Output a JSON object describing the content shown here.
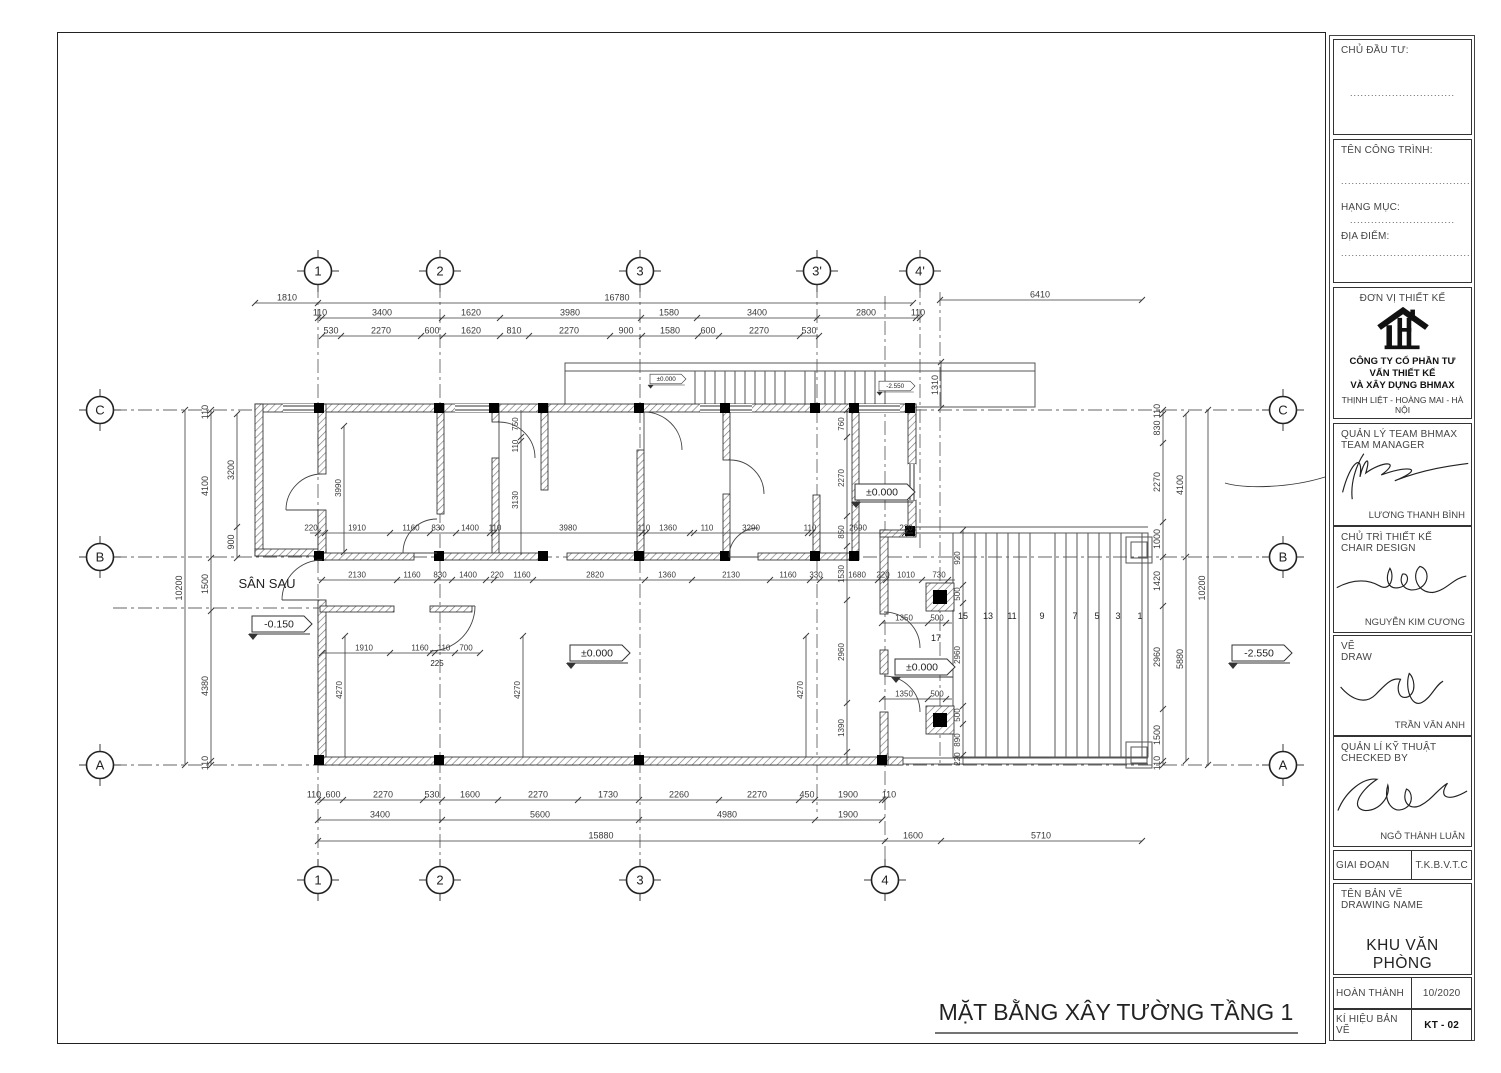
{
  "plan": {
    "bubbles": [
      {
        "t": "1",
        "x": 318,
        "y": 271
      },
      {
        "t": "2",
        "x": 440,
        "y": 271
      },
      {
        "t": "3",
        "x": 640,
        "y": 271
      },
      {
        "t": "3'",
        "x": 817,
        "y": 271
      },
      {
        "t": "4'",
        "x": 920,
        "y": 271
      },
      {
        "t": "1",
        "x": 318,
        "y": 880
      },
      {
        "t": "2",
        "x": 440,
        "y": 880
      },
      {
        "t": "3",
        "x": 640,
        "y": 880
      },
      {
        "t": "4",
        "x": 885,
        "y": 880
      },
      {
        "t": "C",
        "x": 100,
        "y": 410
      },
      {
        "t": "B",
        "x": 100,
        "y": 557
      },
      {
        "t": "A",
        "x": 100,
        "y": 765
      },
      {
        "t": "C",
        "x": 1283,
        "y": 410
      },
      {
        "t": "B",
        "x": 1283,
        "y": 557
      },
      {
        "t": "A",
        "x": 1283,
        "y": 765
      }
    ],
    "dim_rows": [
      {
        "o": "h",
        "y": 303,
        "x1": 255,
        "x2": 318,
        "ticks": [
          255,
          318
        ],
        "labels": [
          {
            "t": "1810",
            "x": 287
          }
        ]
      },
      {
        "o": "h",
        "y": 303,
        "x1": 318,
        "x2": 913,
        "ticks": [
          913
        ],
        "labels": [
          {
            "t": "16780",
            "x": 617
          }
        ]
      },
      {
        "o": "h",
        "y": 300,
        "x1": 940,
        "x2": 1142,
        "ticks": [
          940,
          1142
        ],
        "labels": [
          {
            "t": "6410",
            "x": 1040
          }
        ]
      },
      {
        "o": "h",
        "y": 318,
        "x1": 318,
        "x2": 920,
        "ticks": [
          318,
          322,
          442,
          500,
          641,
          697,
          817,
          916,
          920
        ],
        "labels": [
          {
            "t": "110",
            "x": 320
          },
          {
            "t": "3400",
            "x": 382
          },
          {
            "t": "1620",
            "x": 471
          },
          {
            "t": "3980",
            "x": 570
          },
          {
            "t": "1580",
            "x": 669
          },
          {
            "t": "3400",
            "x": 757
          },
          {
            "t": "2800",
            "x": 866
          },
          {
            "t": "110",
            "x": 918
          }
        ]
      },
      {
        "o": "h",
        "y": 336,
        "x1": 322,
        "x2": 819,
        "ticks": [
          322,
          341,
          421,
          443,
          500,
          529,
          610,
          642,
          698,
          719,
          800,
          819
        ],
        "labels": [
          {
            "t": "530",
            "x": 331
          },
          {
            "t": "2270",
            "x": 381
          },
          {
            "t": "600",
            "x": 432
          },
          {
            "t": "1620",
            "x": 471
          },
          {
            "t": "810",
            "x": 514
          },
          {
            "t": "2270",
            "x": 569
          },
          {
            "t": "900",
            "x": 626
          },
          {
            "t": "1580",
            "x": 670
          },
          {
            "t": "600",
            "x": 708
          },
          {
            "t": "2270",
            "x": 759
          },
          {
            "t": "530",
            "x": 809
          }
        ]
      },
      {
        "o": "h",
        "y": 800,
        "x1": 318,
        "x2": 885,
        "ticks": [
          318,
          322,
          343,
          423,
          442,
          498,
          578,
          639,
          719,
          799,
          815,
          882,
          885
        ],
        "labels": [
          {
            "t": "110",
            "x": 314
          },
          {
            "t": "600",
            "x": 333
          },
          {
            "t": "2270",
            "x": 383
          },
          {
            "t": "530",
            "x": 432
          },
          {
            "t": "1600",
            "x": 470
          },
          {
            "t": "2270",
            "x": 538
          },
          {
            "t": "1730",
            "x": 608
          },
          {
            "t": "2260",
            "x": 679
          },
          {
            "t": "2270",
            "x": 757
          },
          {
            "t": "450",
            "x": 807
          },
          {
            "t": "1900",
            "x": 848
          },
          {
            "t": "110",
            "x": 889
          }
        ]
      },
      {
        "o": "h",
        "y": 820,
        "x1": 318,
        "x2": 882,
        "ticks": [
          318,
          442,
          639,
          815,
          882
        ],
        "labels": [
          {
            "t": "3400",
            "x": 380
          },
          {
            "t": "5600",
            "x": 540
          },
          {
            "t": "4980",
            "x": 727
          },
          {
            "t": "1900",
            "x": 848
          }
        ]
      },
      {
        "o": "h",
        "y": 841,
        "x1": 318,
        "x2": 1142,
        "ticks": [
          318,
          885,
          941,
          1142
        ],
        "labels": [
          {
            "t": "15880",
            "x": 601
          },
          {
            "t": "1600",
            "x": 913
          },
          {
            "t": "5710",
            "x": 1041
          }
        ]
      },
      {
        "o": "v",
        "x": 185,
        "y1": 410,
        "y2": 765,
        "ticks": [
          410,
          765
        ],
        "labels": [
          {
            "t": "10200",
            "y": 588
          }
        ]
      },
      {
        "o": "v",
        "x": 211,
        "y1": 410,
        "y2": 765,
        "ticks": [
          410,
          414,
          558,
          611,
          761,
          765
        ],
        "labels": [
          {
            "t": "110",
            "y": 412
          },
          {
            "t": "4100",
            "y": 486
          },
          {
            "t": "1500",
            "y": 584
          },
          {
            "t": "4380",
            "y": 686
          },
          {
            "t": "110",
            "y": 763
          }
        ]
      },
      {
        "o": "v",
        "x": 237,
        "y1": 414,
        "y2": 558,
        "ticks": [
          414,
          527,
          558
        ],
        "labels": [
          {
            "t": "3200",
            "y": 470
          },
          {
            "t": "900",
            "y": 542
          }
        ]
      },
      {
        "o": "v",
        "x": 1163,
        "y1": 410,
        "y2": 765,
        "ticks": [
          410,
          414,
          443,
          522,
          557,
          606,
          709,
          761,
          765
        ],
        "labels": [
          {
            "t": "110",
            "y": 411
          },
          {
            "t": "830",
            "y": 428
          },
          {
            "t": "2270",
            "y": 482
          },
          {
            "t": "1000",
            "y": 539
          },
          {
            "t": "1420",
            "y": 581
          },
          {
            "t": "2960",
            "y": 657
          },
          {
            "t": "1500",
            "y": 735
          },
          {
            "t": "110",
            "y": 763
          }
        ]
      },
      {
        "o": "v",
        "x": 1186,
        "y1": 414,
        "y2": 761,
        "ticks": [
          414,
          557,
          761
        ],
        "labels": [
          {
            "t": "4100",
            "y": 485
          },
          {
            "t": "5880",
            "y": 659
          }
        ]
      },
      {
        "o": "v",
        "x": 1208,
        "y1": 410,
        "y2": 765,
        "ticks": [
          410,
          765
        ],
        "labels": [
          {
            "t": "10200",
            "y": 588
          }
        ]
      },
      {
        "o": "v",
        "x": 847,
        "y1": 410,
        "y2": 765,
        "ticks": [
          410,
          437,
          516,
          546,
          600,
          703,
          752
        ],
        "labels": [
          {
            "t": "760",
            "y": 424
          },
          {
            "t": "2270",
            "y": 478
          },
          {
            "t": "850",
            "y": 532
          },
          {
            "t": "1530",
            "y": 574
          },
          {
            "t": "2960",
            "y": 652
          },
          {
            "t": "1390",
            "y": 728
          }
        ],
        "fs": 8
      },
      {
        "o": "v",
        "x": 963,
        "y1": 530,
        "y2": 765,
        "ticks": [
          530,
          585,
          603,
          706,
          724,
          755
        ],
        "labels": [
          {
            "t": "920",
            "y": 558
          },
          {
            "t": "500",
            "y": 594
          },
          {
            "t": "2960",
            "y": 655
          },
          {
            "t": "500",
            "y": 715
          },
          {
            "t": "890",
            "y": 740
          },
          {
            "t": "220",
            "y": 759
          }
        ],
        "fs": 8
      },
      {
        "o": "v",
        "x": 521,
        "y1": 410,
        "y2": 555,
        "ticks": [
          437,
          441
        ],
        "labels": [
          {
            "t": "750",
            "y": 424
          },
          {
            "t": "110",
            "y": 446
          },
          {
            "t": "3130",
            "y": 500
          }
        ],
        "fs": 8
      },
      {
        "o": "v",
        "x": 344,
        "y1": 426,
        "y2": 552,
        "ticks": [
          426,
          552
        ],
        "labels": [
          {
            "t": "3990",
            "y": 488
          }
        ],
        "fs": 8
      },
      {
        "o": "v",
        "x": 941,
        "y1": 362,
        "y2": 408,
        "ticks": [
          362,
          408
        ],
        "labels": [
          {
            "t": "1310",
            "y": 385
          }
        ]
      },
      {
        "o": "v",
        "x": 345,
        "y1": 636,
        "y2": 757,
        "ticks": [
          636
        ],
        "labels": [
          {
            "t": "4270",
            "y": 690
          }
        ],
        "fs": 8
      },
      {
        "o": "v",
        "x": 523,
        "y1": 636,
        "y2": 757,
        "ticks": [
          636
        ],
        "labels": [
          {
            "t": "4270",
            "y": 690
          }
        ],
        "fs": 8
      },
      {
        "o": "v",
        "x": 806,
        "y1": 636,
        "y2": 757,
        "ticks": [
          636
        ],
        "labels": [
          {
            "t": "4270",
            "y": 690
          }
        ],
        "fs": 8
      },
      {
        "o": "h",
        "y": 533,
        "x1": 310,
        "x2": 913,
        "ticks": [
          318,
          325,
          390,
          430,
          456,
          490,
          494,
          642,
          646,
          690,
          694,
          808,
          812,
          905
        ],
        "labels": [
          {
            "t": "220",
            "x": 311
          },
          {
            "t": "1910",
            "x": 357
          },
          {
            "t": "1160",
            "x": 411
          },
          {
            "t": "830",
            "x": 438
          },
          {
            "t": "1400",
            "x": 470
          },
          {
            "t": "110",
            "x": 495
          },
          {
            "t": "3980",
            "x": 568
          },
          {
            "t": "110",
            "x": 644
          },
          {
            "t": "1360",
            "x": 668
          },
          {
            "t": "110",
            "x": 707
          },
          {
            "t": "3290",
            "x": 751
          },
          {
            "t": "110",
            "x": 810
          },
          {
            "t": "2690",
            "x": 858
          },
          {
            "t": "220",
            "x": 906
          }
        ],
        "fs": 8
      },
      {
        "o": "h",
        "y": 580,
        "x1": 318,
        "x2": 955,
        "ticks": [
          322,
          397,
          437,
          452,
          486,
          494,
          533,
          645,
          692,
          770,
          810,
          820,
          878,
          886,
          922,
          948
        ],
        "labels": [
          {
            "t": "2130",
            "x": 357
          },
          {
            "t": "1160",
            "x": 412
          },
          {
            "t": "830",
            "x": 440
          },
          {
            "t": "1400",
            "x": 468
          },
          {
            "t": "220",
            "x": 497
          },
          {
            "t": "1160",
            "x": 522
          },
          {
            "t": "2820",
            "x": 595
          },
          {
            "t": "1360",
            "x": 667
          },
          {
            "t": "2130",
            "x": 731
          },
          {
            "t": "1160",
            "x": 788
          },
          {
            "t": "330",
            "x": 816
          },
          {
            "t": "1680",
            "x": 857
          },
          {
            "t": "220",
            "x": 883
          },
          {
            "t": "1010",
            "x": 906
          },
          {
            "t": "730",
            "x": 939
          }
        ],
        "fs": 8
      },
      {
        "o": "h",
        "y": 653,
        "x1": 322,
        "x2": 480,
        "ticks": [
          322,
          390,
          430,
          435,
          455,
          480
        ],
        "labels": [
          {
            "t": "1910",
            "x": 364
          },
          {
            "t": "1160",
            "x": 420
          },
          {
            "t": "110",
            "x": 444
          },
          {
            "t": "700",
            "x": 466
          }
        ],
        "fs": 8
      },
      {
        "o": "h",
        "y": 623,
        "x1": 882,
        "x2": 952,
        "ticks": [
          882,
          928,
          946
        ],
        "labels": [
          {
            "t": "1350",
            "x": 904
          },
          {
            "t": "500",
            "x": 937
          }
        ],
        "fs": 8
      },
      {
        "o": "h",
        "y": 699,
        "x1": 882,
        "x2": 952,
        "ticks": [
          882,
          928,
          946
        ],
        "labels": [
          {
            "t": "1350",
            "x": 904
          },
          {
            "t": "500",
            "x": 937
          }
        ],
        "fs": 8
      }
    ],
    "tags": [
      {
        "t": "-0.150",
        "x": 282,
        "y": 624,
        "s": 1
      },
      {
        "t": "±0.000",
        "x": 600,
        "y": 653,
        "s": 1
      },
      {
        "t": "±0.000",
        "x": 885,
        "y": 492,
        "s": 1
      },
      {
        "t": "±0.000",
        "x": 925,
        "y": 667,
        "s": 1
      },
      {
        "t": "-2.550",
        "x": 1262,
        "y": 653,
        "s": 1
      },
      {
        "t": "±0.000",
        "x": 668,
        "y": 379,
        "s": 0.6
      },
      {
        "t": "-2.550",
        "x": 897,
        "y": 386,
        "s": 0.6
      }
    ],
    "texts": [
      {
        "t": "MẶT BẰNG XÂY TƯỜNG TẦNG 1",
        "x": 1116,
        "y": 1020,
        "s": 23,
        "n": "drawing-title"
      },
      {
        "t": "SÂN SAU",
        "x": 267,
        "y": 588,
        "s": 13,
        "n": "room-label"
      },
      {
        "t": "225",
        "x": 437,
        "y": 666,
        "s": 8,
        "n": "dim-label"
      },
      {
        "t": "17",
        "x": 936,
        "y": 641,
        "s": 9,
        "n": "stair-step-number"
      },
      {
        "t": "15",
        "x": 963,
        "y": 619,
        "s": 9,
        "n": "stair-step-number"
      },
      {
        "t": "13",
        "x": 988,
        "y": 619,
        "s": 9,
        "n": "stair-step-number"
      },
      {
        "t": "11",
        "x": 1012,
        "y": 619,
        "s": 9,
        "n": "stair-step-number"
      },
      {
        "t": "9",
        "x": 1042,
        "y": 619,
        "s": 9,
        "n": "stair-step-number"
      },
      {
        "t": "7",
        "x": 1075,
        "y": 619,
        "s": 9,
        "n": "stair-step-number"
      },
      {
        "t": "5",
        "x": 1097,
        "y": 619,
        "s": 9,
        "n": "stair-step-number"
      },
      {
        "t": "3",
        "x": 1118,
        "y": 619,
        "s": 9,
        "n": "stair-step-number"
      },
      {
        "t": "1",
        "x": 1140,
        "y": 619,
        "s": 9,
        "n": "stair-step-number"
      }
    ]
  },
  "title_block": {
    "investor_label": "CHỦ ĐẦU TƯ:",
    "dots_short": "..............................",
    "dots_long": "..........................................",
    "project_label": "TÊN CÔNG TRÌNH:",
    "category_label": "HẠNG MỤC:",
    "location_label": "ĐỊA ĐIỂM:",
    "designer_label": "ĐƠN VỊ THIẾT KẾ",
    "company_line1": "CÔNG TY CỔ PHẦN TƯ VẤN THIẾT KẾ",
    "company_line2": "VÀ XÂY DỰNG BHMAX",
    "address": "THỊNH LIỆT - HOÀNG MAI - HÀ NỘI",
    "phone": "0904.899.804 - 0833.393.555",
    "roles": [
      {
        "label_vi": "QUẢN LÝ TEAM BHMAX",
        "label_en": "TEAM MANAGER",
        "name": "LƯƠNG THANH BÌNH"
      },
      {
        "label_vi": "CHỦ TRÌ THIẾT KẾ",
        "label_en": "CHAIR DESIGN",
        "name": "NGUYỄN KIM CƯƠNG"
      },
      {
        "label_vi": "VẼ",
        "label_en": "DRAW",
        "name": "TRẦN VĂN ANH"
      },
      {
        "label_vi": "QUẢN LÍ KỸ THUẬT",
        "label_en": "CHECKED BY",
        "name": "NGÔ THÀNH LUÂN"
      }
    ],
    "stage_label": "GIAI ĐOẠN",
    "stage_value": "T.K.B.V.T.C",
    "drawing_name_label_vi": "TÊN BẢN VẼ",
    "drawing_name_label_en": "DRAWING NAME",
    "drawing_name": "KHU VĂN PHÒNG",
    "completed_label": "HOÀN THÀNH",
    "completed_value": "10/2020",
    "code_label": "KÍ HIỆU BẢN VẼ",
    "code_value": "KT - 02"
  }
}
